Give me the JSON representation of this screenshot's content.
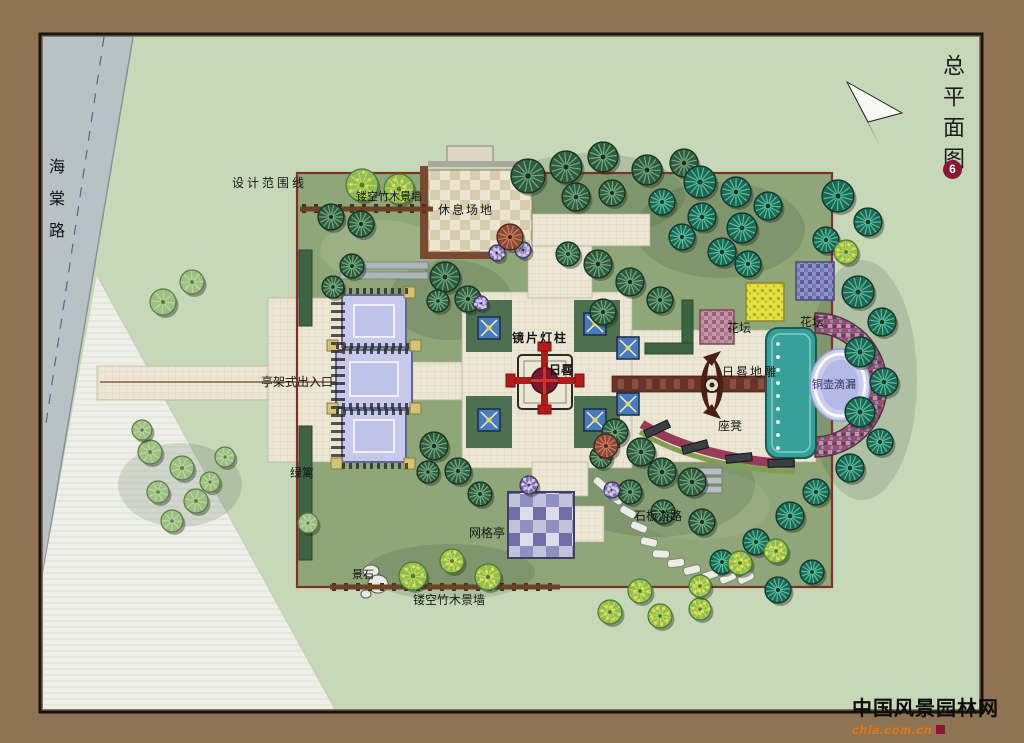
{
  "title": {
    "text": "总平面图",
    "badge": "6"
  },
  "road_label": "海棠路",
  "watermark": {
    "main": "中国风景园林网",
    "sub": "chla.com.cn"
  },
  "plan": {
    "labels": [
      {
        "id": "design-boundary-line",
        "text": "设计范围线"
      },
      {
        "id": "latticed-bamboo-wall-top",
        "text": "镂空竹木景墙"
      },
      {
        "id": "rest-area",
        "text": "休息场地"
      },
      {
        "id": "mirror-lamp-column",
        "text": "镜片灯柱"
      },
      {
        "id": "sundial",
        "text": "日晷"
      },
      {
        "id": "flower-bed-west",
        "text": "花坛"
      },
      {
        "id": "flower-bed-east",
        "text": "花坛"
      },
      {
        "id": "sundial-ground-relief",
        "text": "日晷地雕"
      },
      {
        "id": "copper-clepsydra",
        "text": "铜壶滴漏"
      },
      {
        "id": "bench-seat",
        "text": "座凳"
      },
      {
        "id": "pergola-entrance",
        "text": "亭架式出入口"
      },
      {
        "id": "hedge",
        "text": "绿篱"
      },
      {
        "id": "grid-pavilion",
        "text": "网格亭"
      },
      {
        "id": "stone-slab-path",
        "text": "石板游路"
      },
      {
        "id": "landscape-stone",
        "text": "景石"
      },
      {
        "id": "latticed-bamboo-wall-bottom",
        "text": "镂空竹木景墙"
      }
    ]
  },
  "colors": {
    "frame": "#8f7453",
    "canvas_bg": "#c6d8b8",
    "lawn": "#8fa678",
    "road": "#b7c1c6",
    "path": "#ece7d5",
    "boundary_line": "#7a3326",
    "pool_water": "#c6c9ec",
    "sundial_red": "#b81818",
    "sundial_core": "#7a1830",
    "axis_band": "#6a3228",
    "clepsydra_ellipse": "#c9cdf0",
    "teal_structure": "#37a099",
    "bench_band": "#9a3a5a",
    "tree_dark": "#2f5c41",
    "tree_dark_streak": "#7fb889",
    "tree_teal": "#1e6752",
    "tree_teal_streak": "#5fd0b0",
    "tree_light": "#8fbc55",
    "tree_light_dot": "#e8e13c",
    "tree_plain": "#9dbf83",
    "bush_purple": "#7a6aa8",
    "tree_red": "#8a4a38",
    "title_badge_bg": "#8b1535",
    "watermark_orange": "#e67817"
  }
}
